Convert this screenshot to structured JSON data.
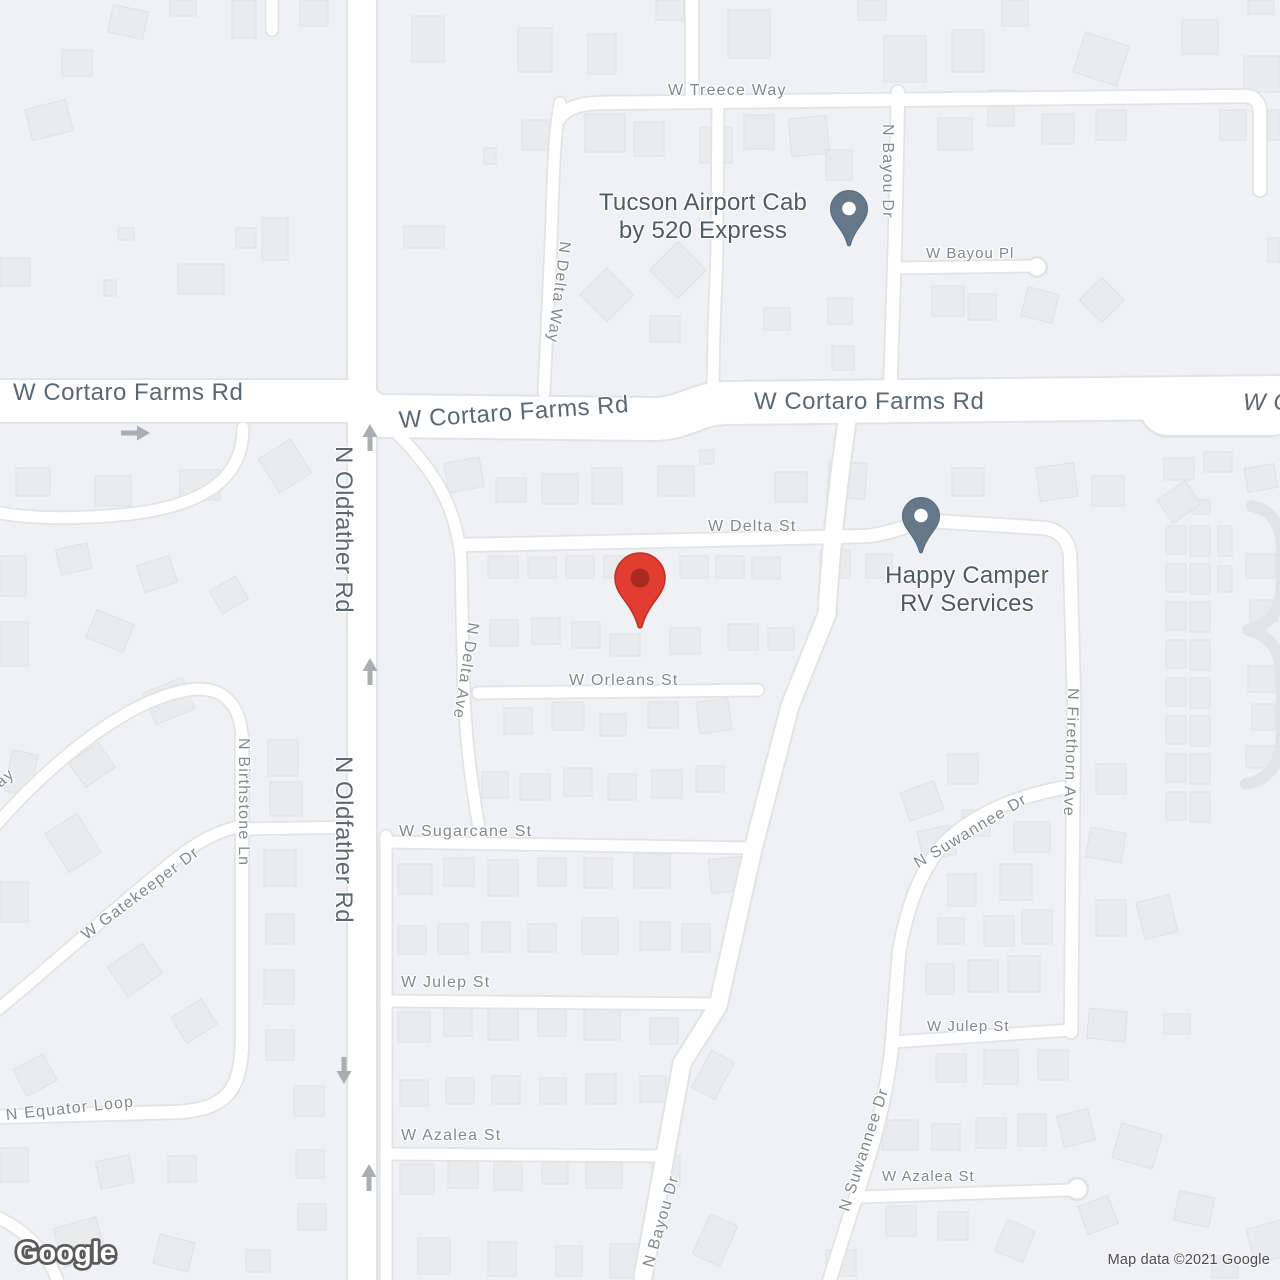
{
  "streets": {
    "treece_way": "W Treece Way",
    "bayou_dr": "N Bayou Dr",
    "bayou_pl": "W Bayou Pl",
    "delta_way": "N Delta Way",
    "cortaro_farms_rd": "W Cortaro Farms Rd",
    "cortaro_farms_rd_cut": "W C",
    "delta_st": "W Delta St",
    "oldfather_rd": "N Oldfather Rd",
    "delta_ave": "N Delta Ave",
    "orleans_st": "W Orleans St",
    "suwannee_dr": "N Suwannee Dr",
    "firethorn_ave": "N Firethorn Ave",
    "gatekeeper_dr": "W Gatekeeper Dr",
    "birthstone_ln": "N Birthstone Ln",
    "sugarcane_st": "W Sugarcane St",
    "way_fragment": "Way",
    "julep_st": "W Julep St",
    "equator_loop": "N Equator Loop",
    "azalea_st": "W Azalea St"
  },
  "pois": {
    "tucson_cab": {
      "line1": "Tucson Airport Cab",
      "line2": "by 520 Express"
    },
    "happy_camper": {
      "line1": "Happy Camper",
      "line2": "RV Services"
    }
  },
  "markers": {
    "destination_pin_color": "#e13d31",
    "destination_pin_inner": "#a72b20",
    "poi_pin_color": "#64788a"
  },
  "colors": {
    "land": "#eff1f4",
    "building": "#e9ebed",
    "road": "#ffffff",
    "road_casing": "#e1e4e7",
    "street_label": "#7f8990",
    "major_label": "#5a6874",
    "poi_label": "#4d5b67",
    "arrow": "#a9aeb3"
  },
  "watermark": {
    "text": "Google"
  },
  "attribution": {
    "text": "Map data ©2021 Google"
  }
}
